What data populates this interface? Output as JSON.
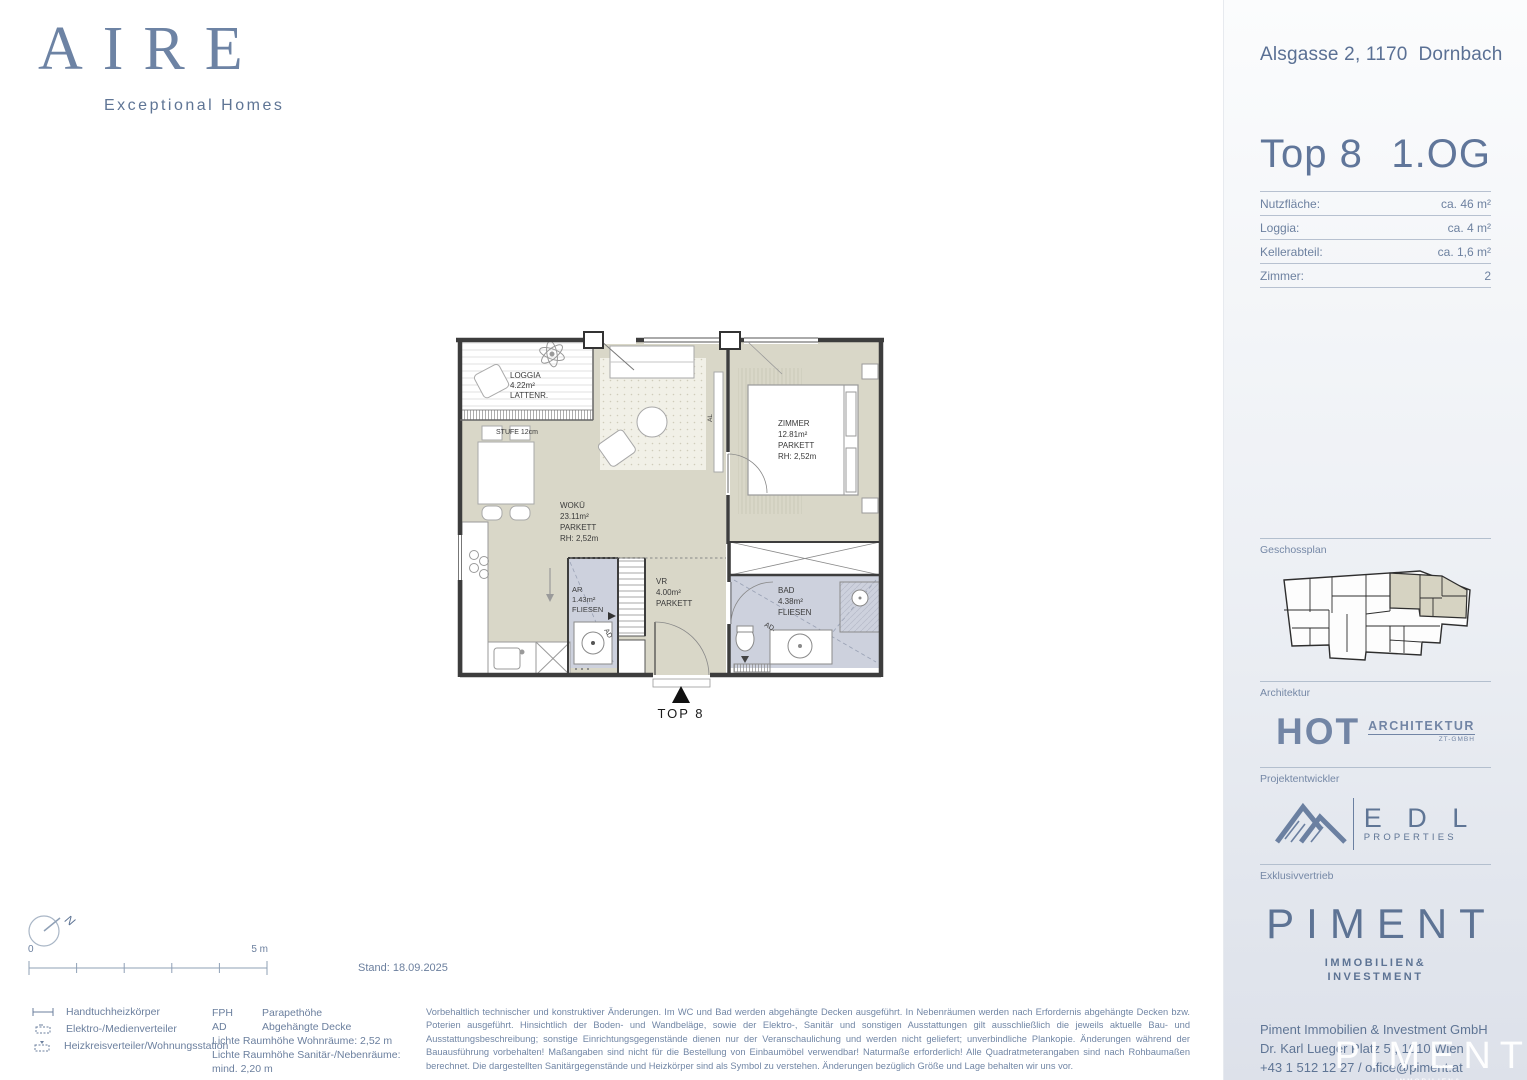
{
  "brand": {
    "logo": "AIRE",
    "tagline": "Exceptional Homes"
  },
  "sidebar": {
    "address": "Alsgasse 2, 1170  Dornbach",
    "unit": "Top 8",
    "floor": "1.OG",
    "facts": [
      {
        "label": "Nutzfläche:",
        "value": "ca. 46 m²"
      },
      {
        "label": "Loggia:",
        "value": "ca. 4 m²"
      },
      {
        "label": "Kellerabteil:",
        "value": "ca. 1,6 m²"
      },
      {
        "label": "Zimmer:",
        "value": "2"
      }
    ],
    "sections": {
      "geschossplan": "Geschossplan",
      "architektur": "Architektur",
      "projektentwickler": "Projektentwickler",
      "exklusivvertrieb": "Exklusivvertrieb"
    },
    "architect_logo": {
      "main": "HOT",
      "sub": "ARCHITEKTUR",
      "sub2": "ZT-GMBH"
    },
    "developer_logo": {
      "main": "E D L",
      "sub": "PROPERTIES"
    },
    "piment_logo": {
      "main": "PIMENT",
      "sub1": "IMMOBILIEN&",
      "sub2": "INVESTMENT"
    },
    "contact": [
      "Piment Immobilien & Investment GmbH",
      "Dr. Karl Lueger Platz 5 , 1010 Wien",
      "+43 1 512 12 27 / office@piment.at"
    ],
    "website": "www.aire.wien",
    "watermark": {
      "main": "PIMENT",
      "sub1": "IMMOBILIEN&",
      "sub2": "INVESTMENT"
    }
  },
  "plan": {
    "rooms": {
      "loggia": [
        "LOGGIA",
        "4.22m²",
        "LATTENR."
      ],
      "wokue": [
        "WOKÜ",
        "23.11m²",
        "PARKETT",
        "RH: 2,52m"
      ],
      "zimmer": [
        "ZIMMER",
        "12.81m²",
        "PARKETT",
        "RH: 2,52m"
      ],
      "vr": [
        "VR",
        "4.00m²",
        "PARKETT"
      ],
      "ar": [
        "AR",
        "1.43m²",
        "FLIESEN"
      ],
      "bad": [
        "BAD",
        "4.38m²",
        "FLIESEN"
      ]
    },
    "stufe": "STUFE 12cm",
    "ad_bad": "AD.",
    "ad_ar": "AD",
    "al": "AL",
    "entrance_label": "TOP 8"
  },
  "footer": {
    "compass": "N",
    "scale_start": "0",
    "scale_end": "5 m",
    "stand": "Stand: 18.09.2025",
    "legend_symbols": [
      {
        "label": "Handtuchheizkörper"
      },
      {
        "label": "Elektro-/Medienverteiler"
      },
      {
        "label": "Heizkreisverteiler/Wohnungsstation"
      }
    ],
    "legend_abbr": [
      {
        "abbr": "FPH",
        "label": "Parapethöhe"
      },
      {
        "abbr": "AD",
        "label": "Abgehängte Decke"
      }
    ],
    "legend_lines": [
      "Lichte Raumhöhe Wohnräume:  2,52 m",
      "Lichte Raumhöhe Sanitär-/Nebenräume:  mind. 2,20 m"
    ],
    "disclaimer": "Vorbehaltlich technischer und konstruktiver Änderungen. Im WC und Bad werden abgehängte Decken ausgeführt. In Nebenräumen werden nach Erfordernis abgehängte Decken bzw. Poterien ausgeführt. Hinsichtlich der Boden- und Wandbeläge, sowie der Elektro-, Sanitär und sonstigen Ausstattungen gilt ausschließlich die jeweils aktuelle Bau- und Ausstattungsbeschreibung; sonstige Einrichtungsgegenstände dienen nur der Veranschaulichung und werden nicht geliefert; unverbindliche Plankopie. Änderungen während der Bauausführung vorbehalten! Maßangaben sind nicht für die Bestellung von Einbaumöbel verwendbar! Naturmaße erforderlich! Alle Quadratmeterangaben sind nach Rohbaumaßen berechnet. Die dargestellten Sanitärgegenstände und Heizkörper sind als Symbol zu verstehen. Änderungen bezüglich Größe und Lage behalten wir uns vor."
  },
  "colors": {
    "accent": "#5d7394",
    "room_beige": "#d9d7c8",
    "room_wet": "#cdd1dd",
    "wall": "#3d3d3d",
    "highlight": "#d6d3c2"
  }
}
